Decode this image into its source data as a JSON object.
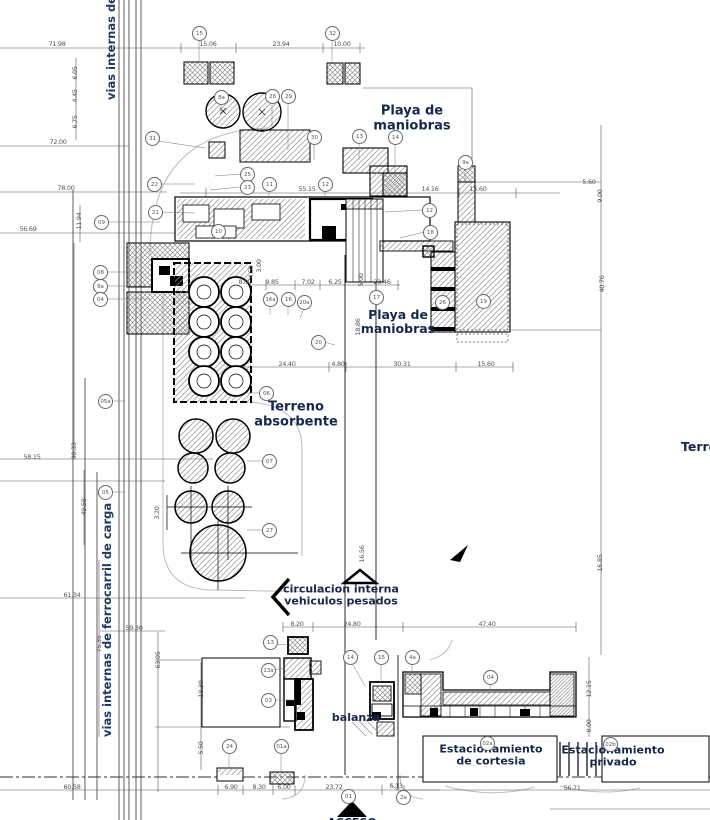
{
  "colors": {
    "label_navy": "#1f3864",
    "label_dark": "#15284b",
    "dim_gray": "#555555",
    "line_black": "#000000"
  },
  "labels": {
    "rail_top": "vias internas de fe",
    "rail_bottom": "vias internas de ferrocarril de carga",
    "playa1": [
      "Playa de",
      "maniobras"
    ],
    "playa2": [
      "Playa de",
      "maniobras"
    ],
    "terreno": [
      "Terreno",
      "absorbente"
    ],
    "circulacion": [
      "circulacion interna",
      "vehiculos pesados"
    ],
    "balanza": "balanza",
    "cortesia": [
      "Estacionamiento",
      "de cortesia"
    ],
    "privado": [
      "Estacionamiento",
      "privado"
    ],
    "terre": "Terre",
    "acceso": "ACCESO"
  },
  "dimensions": [
    {
      "t": "71.98",
      "x": 57,
      "y": 44
    },
    {
      "t": "15.06",
      "x": 208,
      "y": 44
    },
    {
      "t": "23.94",
      "x": 281,
      "y": 44
    },
    {
      "t": "10.00",
      "x": 342,
      "y": 44
    },
    {
      "t": "6.05",
      "x": 75,
      "y": 73,
      "v": 1
    },
    {
      "t": "4.45",
      "x": 75,
      "y": 96,
      "v": 1
    },
    {
      "t": "6.75",
      "x": 75,
      "y": 122,
      "v": 1
    },
    {
      "t": "72.00",
      "x": 58,
      "y": 142
    },
    {
      "t": "78.00",
      "x": 66,
      "y": 188
    },
    {
      "t": "11.94",
      "x": 79,
      "y": 221,
      "v": 1
    },
    {
      "t": "56.69",
      "x": 28,
      "y": 229
    },
    {
      "t": "55.15",
      "x": 307,
      "y": 189
    },
    {
      "t": "14.16",
      "x": 430,
      "y": 189
    },
    {
      "t": "15.60",
      "x": 478,
      "y": 189
    },
    {
      "t": "5.60",
      "x": 589,
      "y": 182
    },
    {
      "t": "9.00",
      "x": 600,
      "y": 196,
      "v": 1
    },
    {
      "t": "40.76",
      "x": 602,
      "y": 284,
      "v": 1
    },
    {
      "t": "3.00",
      "x": 259,
      "y": 266,
      "v": 1
    },
    {
      "t": "4.59",
      "x": 251,
      "y": 272,
      "v": 1
    },
    {
      "t": "8.00",
      "x": 245,
      "y": 282
    },
    {
      "t": "9.85",
      "x": 272,
      "y": 282
    },
    {
      "t": "7.02",
      "x": 308,
      "y": 282
    },
    {
      "t": "6.25",
      "x": 335,
      "y": 282
    },
    {
      "t": "5.00",
      "x": 361,
      "y": 280,
      "v": 1
    },
    {
      "t": "23.46",
      "x": 382,
      "y": 282
    },
    {
      "t": "24.40",
      "x": 287,
      "y": 364
    },
    {
      "t": "4.80",
      "x": 338,
      "y": 364
    },
    {
      "t": "30.31",
      "x": 402,
      "y": 364
    },
    {
      "t": "15.60",
      "x": 486,
      "y": 364
    },
    {
      "t": "18.86",
      "x": 358,
      "y": 327,
      "v": 1
    },
    {
      "t": "58.15",
      "x": 32,
      "y": 457
    },
    {
      "t": "90.33",
      "x": 74,
      "y": 451,
      "v": 1
    },
    {
      "t": "49.58",
      "x": 84,
      "y": 507,
      "v": 1
    },
    {
      "t": "3.20",
      "x": 157,
      "y": 513,
      "v": 1
    },
    {
      "t": "16.56",
      "x": 362,
      "y": 554,
      "v": 1
    },
    {
      "t": "16.85",
      "x": 600,
      "y": 563,
      "v": 1
    },
    {
      "t": "61.34",
      "x": 72,
      "y": 595
    },
    {
      "t": "59.30",
      "x": 134,
      "y": 628
    },
    {
      "t": "75.35",
      "x": 99,
      "y": 644,
      "v": 1
    },
    {
      "t": "63.05",
      "x": 158,
      "y": 660,
      "v": 1
    },
    {
      "t": "8.20",
      "x": 297,
      "y": 624
    },
    {
      "t": "24.80",
      "x": 352,
      "y": 624
    },
    {
      "t": "47.40",
      "x": 487,
      "y": 624
    },
    {
      "t": "18.30",
      "x": 201,
      "y": 689,
      "v": 1
    },
    {
      "t": "5.50",
      "x": 201,
      "y": 748,
      "v": 1
    },
    {
      "t": "12.15",
      "x": 589,
      "y": 689,
      "v": 1
    },
    {
      "t": "8.00",
      "x": 589,
      "y": 726,
      "v": 1
    },
    {
      "t": "6.90",
      "x": 231,
      "y": 787
    },
    {
      "t": "8.30",
      "x": 259,
      "y": 787
    },
    {
      "t": "6.00",
      "x": 284,
      "y": 787
    },
    {
      "t": "23.72",
      "x": 334,
      "y": 787
    },
    {
      "t": "6.13",
      "x": 396,
      "y": 786
    },
    {
      "t": "60.58",
      "x": 72,
      "y": 787
    },
    {
      "t": "56.71",
      "x": 572,
      "y": 788
    }
  ],
  "bubbles": [
    {
      "n": "15",
      "x": 199,
      "y": 33
    },
    {
      "n": "32",
      "x": 332,
      "y": 33
    },
    {
      "n": "8a",
      "x": 221,
      "y": 97
    },
    {
      "n": "28",
      "x": 272,
      "y": 96
    },
    {
      "n": "29",
      "x": 288,
      "y": 96
    },
    {
      "n": "31",
      "x": 152,
      "y": 138
    },
    {
      "n": "30",
      "x": 314,
      "y": 137
    },
    {
      "n": "13",
      "x": 359,
      "y": 136
    },
    {
      "n": "14",
      "x": 395,
      "y": 137
    },
    {
      "n": "22",
      "x": 154,
      "y": 184
    },
    {
      "n": "25",
      "x": 247,
      "y": 174
    },
    {
      "n": "23",
      "x": 247,
      "y": 187
    },
    {
      "n": "11",
      "x": 269,
      "y": 184
    },
    {
      "n": "12",
      "x": 325,
      "y": 184
    },
    {
      "n": "21",
      "x": 155,
      "y": 212
    },
    {
      "n": "09",
      "x": 101,
      "y": 222
    },
    {
      "n": "10",
      "x": 218,
      "y": 231
    },
    {
      "n": "12",
      "x": 429,
      "y": 210
    },
    {
      "n": "18",
      "x": 430,
      "y": 232
    },
    {
      "n": "9a",
      "x": 465,
      "y": 162
    },
    {
      "n": "08",
      "x": 100,
      "y": 272
    },
    {
      "n": "8a",
      "x": 100,
      "y": 286
    },
    {
      "n": "04",
      "x": 100,
      "y": 299
    },
    {
      "n": "16a",
      "x": 270,
      "y": 299
    },
    {
      "n": "16",
      "x": 288,
      "y": 299
    },
    {
      "n": "20a",
      "x": 304,
      "y": 302
    },
    {
      "n": "17",
      "x": 376,
      "y": 297
    },
    {
      "n": "26",
      "x": 442,
      "y": 302
    },
    {
      "n": "19",
      "x": 483,
      "y": 301
    },
    {
      "n": "20",
      "x": 318,
      "y": 342
    },
    {
      "n": "06",
      "x": 266,
      "y": 393
    },
    {
      "n": "05a",
      "x": 105,
      "y": 401
    },
    {
      "n": "07",
      "x": 269,
      "y": 461
    },
    {
      "n": "05",
      "x": 105,
      "y": 492
    },
    {
      "n": "27",
      "x": 269,
      "y": 530
    },
    {
      "n": "13",
      "x": 270,
      "y": 642
    },
    {
      "n": "13a",
      "x": 268,
      "y": 670
    },
    {
      "n": "03",
      "x": 268,
      "y": 700
    },
    {
      "n": "14",
      "x": 350,
      "y": 657
    },
    {
      "n": "15",
      "x": 381,
      "y": 657
    },
    {
      "n": "4a",
      "x": 412,
      "y": 657
    },
    {
      "n": "04",
      "x": 490,
      "y": 677
    },
    {
      "n": "24",
      "x": 229,
      "y": 746
    },
    {
      "n": "01a",
      "x": 281,
      "y": 746
    },
    {
      "n": "02a",
      "x": 487,
      "y": 743
    },
    {
      "n": "02b",
      "x": 610,
      "y": 744
    },
    {
      "n": "01",
      "x": 348,
      "y": 796
    },
    {
      "n": "2a",
      "x": 403,
      "y": 797
    }
  ]
}
